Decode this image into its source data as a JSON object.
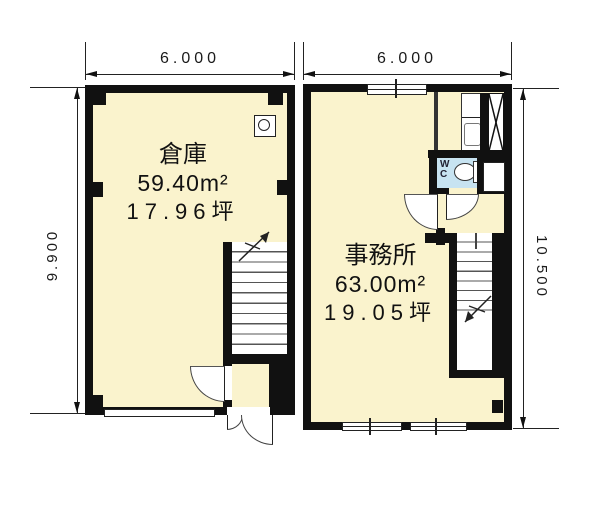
{
  "colors": {
    "wall": "#111111",
    "floor": "#faf3cd",
    "wc": "#c7e3f1",
    "ink": "#222222"
  },
  "plans": {
    "left": {
      "room": "倉庫",
      "area": "59.40m²",
      "tsubo": "17.96坪",
      "width": "6.000",
      "height": "9.900"
    },
    "right": {
      "room": "事務所",
      "area": "63.00m²",
      "tsubo": "19.05坪",
      "width": "6.000",
      "height": "10.500",
      "wc": "WC"
    }
  }
}
